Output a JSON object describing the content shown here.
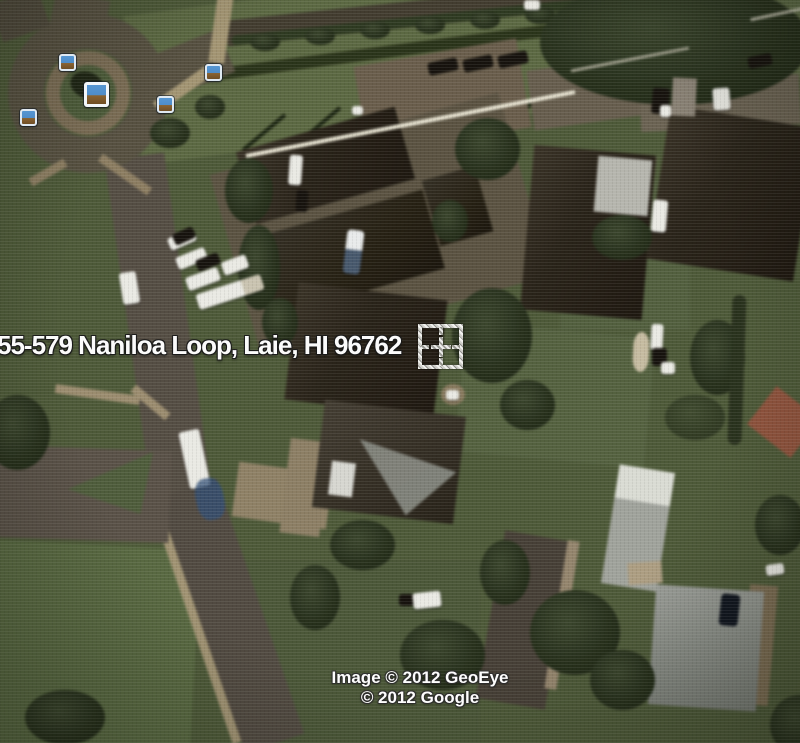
{
  "window": {
    "width_px": 800,
    "height_px": 743
  },
  "map": {
    "view_type": "satellite-imagery",
    "address_label": "55-579 Naniloa Loop, Laie, HI 96762",
    "attribution": {
      "line1": "Image © 2012 GeoEye",
      "line2": "© 2012 Google"
    },
    "markers": {
      "type": "photo-marker",
      "count": 5
    },
    "crosshair_present": true,
    "colors": {
      "label_text": "#fbfbfb",
      "label_outline": "#1c1c1c",
      "marker_frame": "#dfe9f2",
      "marker_sky": "#5696d2",
      "marker_ground": "#8a6331",
      "grass_base": "#4d5938",
      "road": "#554d42"
    }
  }
}
